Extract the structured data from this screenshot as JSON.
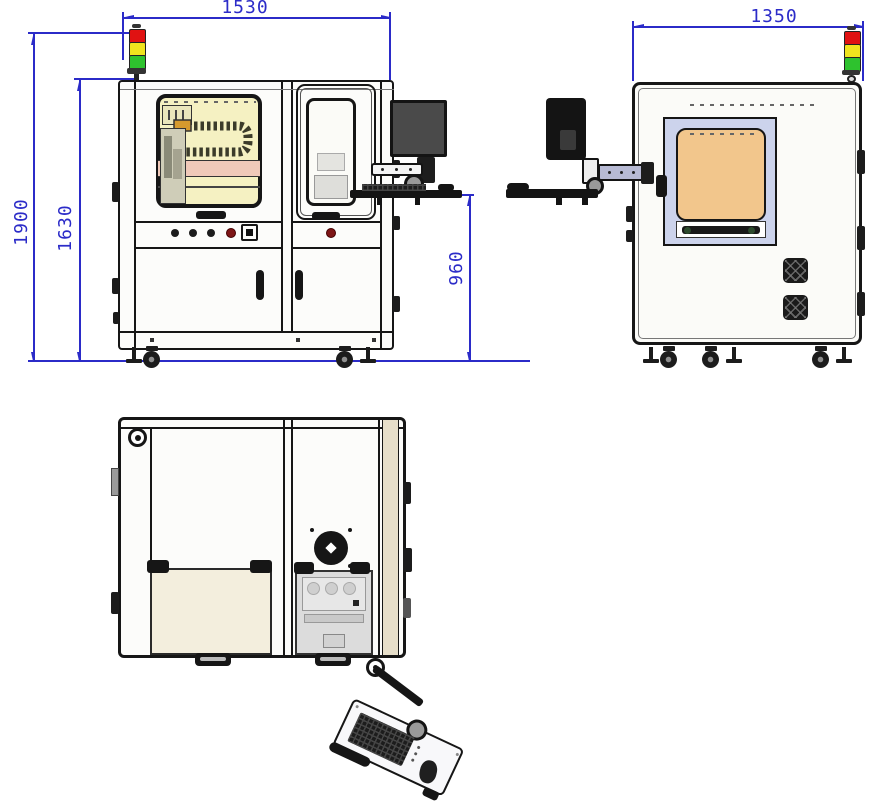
{
  "drawing": {
    "type": "engineering-three-view-machine-drawing",
    "views": [
      "front",
      "side",
      "top"
    ],
    "dimensions": {
      "front_width": "1530",
      "overall_height": "1900",
      "frame_height": "1630",
      "keyboard_height": "960",
      "side_depth": "1350"
    }
  },
  "colors": {
    "dim_blue": "#2b2bc8",
    "line_dark": "#161616",
    "window_tint": "#f5f1c2",
    "belt_pink": "#f0c9b9",
    "panel_orange": "#f2c68c",
    "frame_blue": "#ccd3ec",
    "top_cream": "#f3eedd",
    "top_beige": "#e7dfca",
    "light_red": "#e01212",
    "light_yellow": "#f0e41e",
    "light_green": "#2ec22e"
  }
}
